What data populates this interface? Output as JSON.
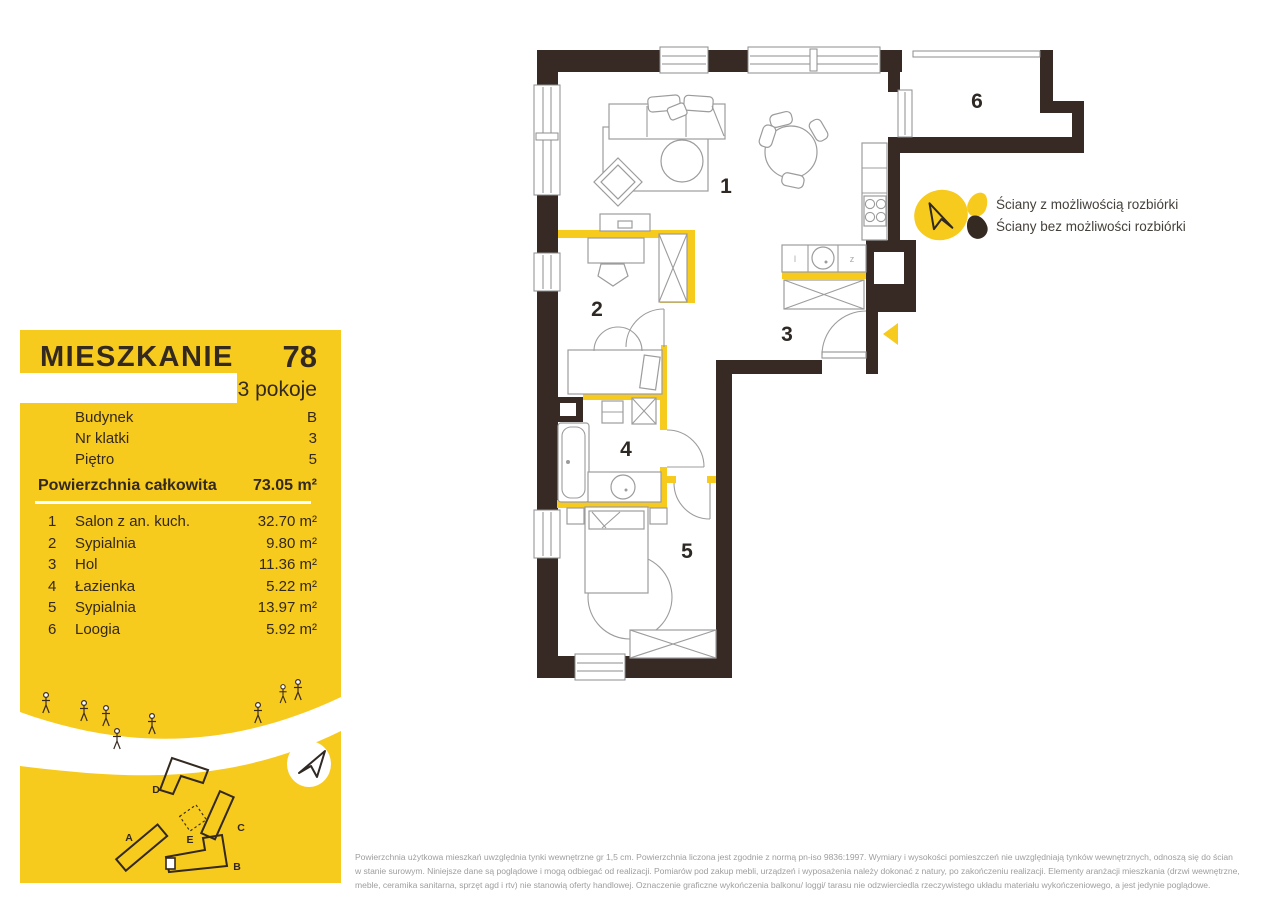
{
  "colors": {
    "accent_yellow": "#f7ca1e",
    "wall_dark": "#372a25",
    "text_dark": "#33291f",
    "muted_gray": "#9e9e9e"
  },
  "panel": {
    "title": "MIESZKANIE",
    "number": "78",
    "rooms_count": "3 pokoje",
    "info": [
      {
        "label": "Budynek",
        "value": "B"
      },
      {
        "label": "Nr klatki",
        "value": "3"
      },
      {
        "label": "Piętro",
        "value": "5"
      }
    ],
    "total_label": "Powierzchnia całkowita",
    "total_value": "73.05 m²",
    "rooms": [
      {
        "no": "1",
        "name": "Salon z an. kuch.",
        "area": "32.70 m²"
      },
      {
        "no": "2",
        "name": "Sypialnia",
        "area": "9.80 m²"
      },
      {
        "no": "3",
        "name": "Hol",
        "area": "11.36 m²"
      },
      {
        "no": "4",
        "name": "Łazienka",
        "area": "5.22 m²"
      },
      {
        "no": "5",
        "name": "Sypialnia",
        "area": "13.97 m²"
      },
      {
        "no": "6",
        "name": "Loogia",
        "area": "5.92 m²"
      }
    ],
    "site_map": {
      "labels": {
        "a": "A",
        "b": "B",
        "c": "C",
        "d": "D",
        "e": "E"
      }
    }
  },
  "floorplan": {
    "room_labels": {
      "r1": "1",
      "r2": "2",
      "r3": "3",
      "r4": "4",
      "r5": "5",
      "r6": "6"
    },
    "kitchen_marks": {
      "left": "l",
      "right": "z"
    }
  },
  "legend": {
    "demolishable": "Ściany z możliwością rozbiórki",
    "non_demolishable": "Ściany bez możliwości rozbiórki"
  },
  "footer": {
    "lines": [
      "Powierzchnia użytkowa mieszkań uwzględnia tynki wewnętrzne gr 1,5 cm. Powierzchnia liczona jest zgodnie z normą pn-iso 9836:1997. Wymiary i wysokości pomieszczeń nie uwzględniają tynków wewnętrznych, odnoszą się do ścian",
      "w stanie surowym. Niniejsze dane są poglądowe i mogą odbiegać od realizacji. Pomiarów pod zakup mebli, urządzeń i wyposażenia należy dokonać z natury, po zakończeniu realizacji. Elementy aranżacji mieszkania (drzwi wewnętrzne,",
      "meble, ceramika sanitarna, sprzęt agd i rtv) nie stanowią oferty handlowej. Oznaczenie graficzne wykończenia balkonu/ loggi/ tarasu nie odzwierciedla rzeczywistego układu materiału wykończeniowego, a jest jedynie poglądowe."
    ]
  }
}
